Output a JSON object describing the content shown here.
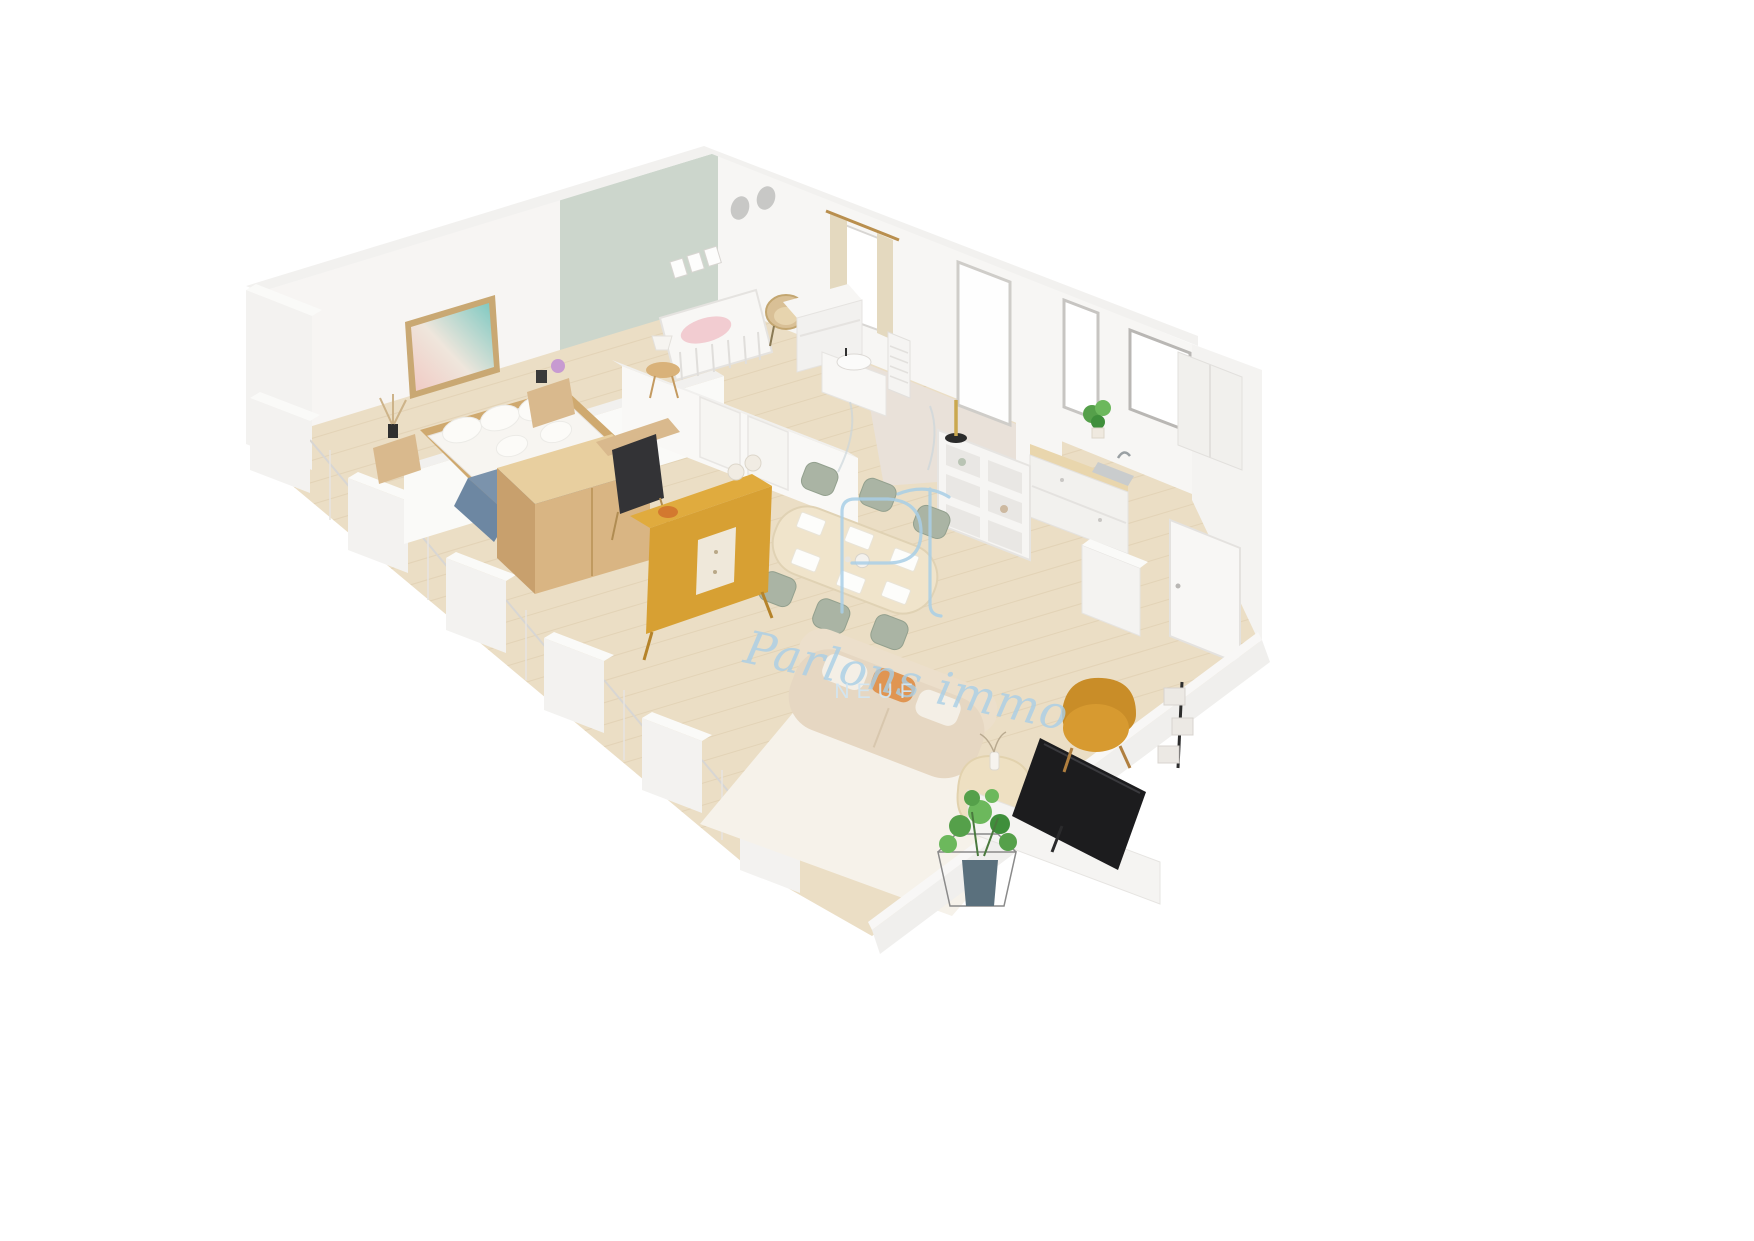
{
  "watermark": {
    "monogram": "PI",
    "script": "Parlons immo",
    "caption": "NEUF"
  },
  "colors": {
    "background": "#ffffff",
    "wall_white": "#f6f5f3",
    "wall_top": "#fbfaf9",
    "wall_shade": "#e9e7e4",
    "nursery_wall": "#ccd6cc",
    "floor_wood": "#ebdec5",
    "plank_line": "#d9c6a6",
    "bathroom_tile": "#e9e1d9",
    "rug": "#f6f2ea",
    "sofa": "#e6d7c2",
    "cushion_orange": "#e09552",
    "sideboard": "#d7a033",
    "armchair": "#d79a30",
    "dining_chair": "#aab4a4",
    "table_wood": "#f0e4cb",
    "bed_blanket": "#7b93ac",
    "wood_light": "#d9b98d",
    "crib_pink": "#f2ccd1",
    "plant_green": "#55a04a",
    "planter_teal": "#5a707d",
    "tv_black": "#1c1c1e",
    "curtain_beige": "#e4d9bf",
    "watermark_blue": "#a9cfe7",
    "caption_blue": "#d3e6f2",
    "art_pink": "#f0c9c3",
    "art_teal": "#7cc8c1"
  },
  "scene": {
    "type": "3d-isometric-floor-plan",
    "rooms": [
      {
        "name": "bedroom",
        "furniture": [
          "double-bed",
          "denim-throw",
          "wardrobe",
          "nightstand-left",
          "nightstand-right",
          "wall-art",
          "desk-chair",
          "dried-plant"
        ]
      },
      {
        "name": "nursery",
        "furniture": [
          "crib",
          "rattan-chair",
          "dresser",
          "side-table",
          "table-lamp",
          "wall-frames",
          "curtains",
          "window"
        ]
      },
      {
        "name": "bathroom",
        "furniture": [
          "vanity-sink",
          "towel-radiator",
          "shower-screen",
          "tall-window"
        ]
      },
      {
        "name": "kitchen",
        "furniture": [
          "sink-counter",
          "window",
          "tall-cabinets",
          "open-shelf-unit",
          "potted-plant",
          "candle-holder"
        ]
      },
      {
        "name": "living-dining",
        "furniture": [
          "dining-table",
          "dining-chairs",
          "sideboard",
          "sofa",
          "rug",
          "coffee-table",
          "tv",
          "tv-console",
          "armchair",
          "floor-plant",
          "tiered-plant-stand"
        ]
      },
      {
        "name": "entry",
        "furniture": [
          "front-door",
          "utility-cabinet"
        ]
      }
    ]
  }
}
